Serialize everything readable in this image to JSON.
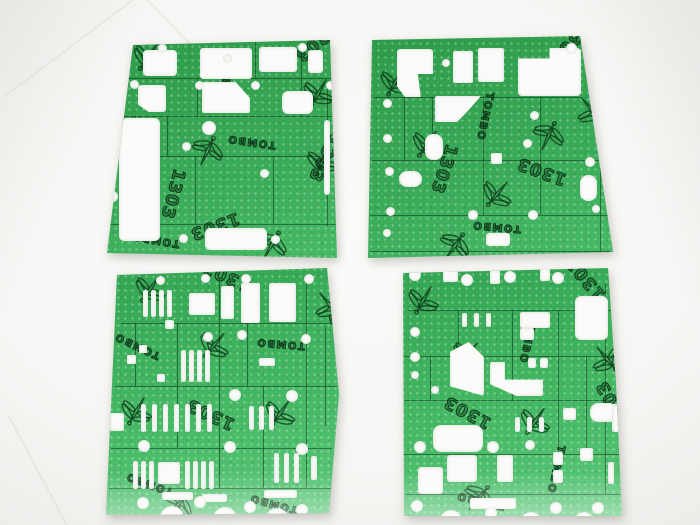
{
  "scene": {
    "description": "Product photo of four green die-cut fiber gasket sheets arranged two by two on a white studio backdrop",
    "background_color": "#f7f6f4",
    "sheet_color": "#35a554",
    "print_color": "#0b2d15",
    "cutout_color": "#fbfbf9"
  },
  "print": {
    "part_number": "1303",
    "brand": "TOMBO",
    "logo": "dragonfly"
  },
  "gaskets": [
    {
      "position": "top-left"
    },
    {
      "position": "top-right"
    },
    {
      "position": "bottom-left"
    },
    {
      "position": "bottom-right"
    }
  ]
}
